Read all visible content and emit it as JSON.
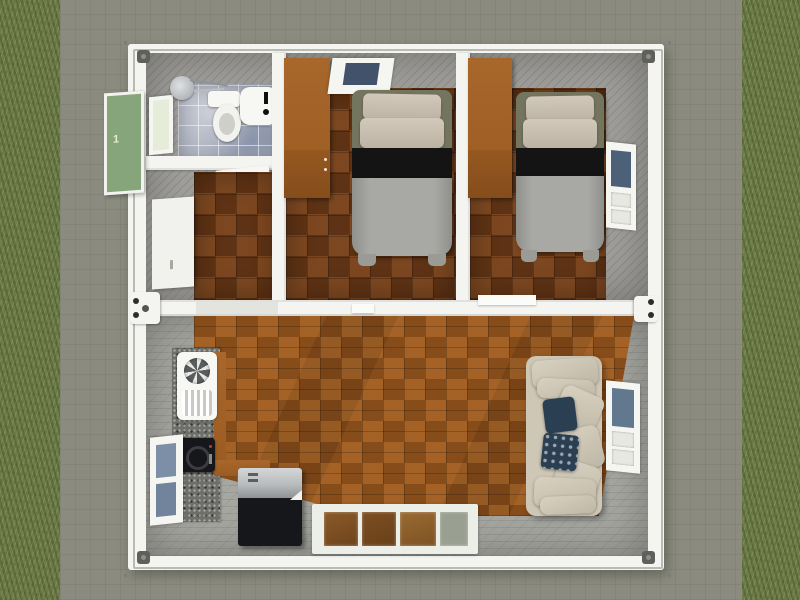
{
  "scene": {
    "description": "3D top-down render of a two-module container home on a concrete pad surrounded by grass",
    "house_number": "1",
    "objects": [
      "green-entry-door",
      "bathroom-window",
      "shower-mixer",
      "toilet",
      "washbasin",
      "bathroom-door",
      "hallway-door-panel",
      "wardrobe",
      "single-bed",
      "bedroom-window",
      "wardrobe",
      "single-bed",
      "bedroom-side-window",
      "kitchen-counter",
      "kitchen-sink",
      "cooktop",
      "kitchen-window",
      "chest-freezer",
      "sofa",
      "navy-throw-pillows",
      "living-room-window",
      "sliding-glass-door"
    ]
  },
  "palette": {
    "grass": "#6f7c4a",
    "pad": "#8b8c7f",
    "frame": "#f4f4f1",
    "rail": "#b9bab2",
    "wall": "#a09f9b",
    "tile": "#a9aebc",
    "floor-bedroom": "#6d3a17",
    "floor-living": "#99561d",
    "wood": "#a8672b",
    "bed-frame": "#74755f",
    "bed-black": "#141414",
    "blanket": "#a8a8a4",
    "sofa": "#cfc7b6",
    "navy": "#2b3f53",
    "window-blue": "#42526b",
    "door-green": "#86a57a",
    "appliance-black": "#16171b",
    "steel": "#b9bcbd"
  }
}
